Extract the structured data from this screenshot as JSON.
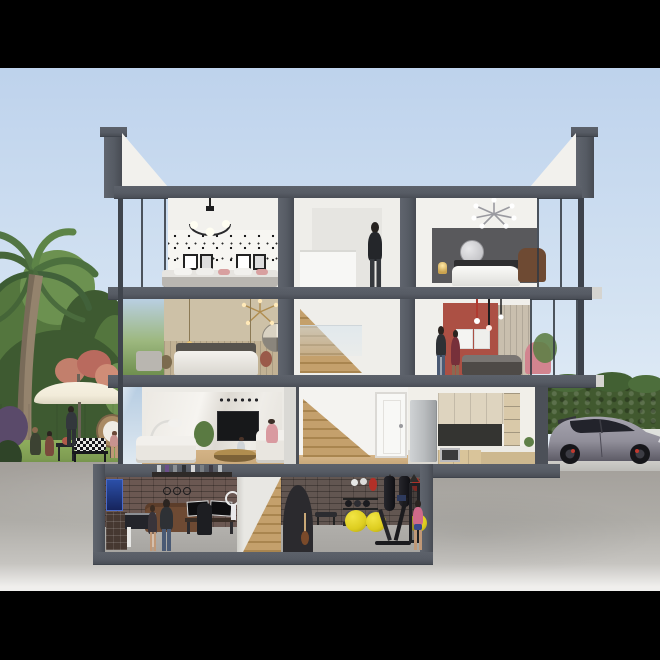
{
  "scene": {
    "description": "Photorealistic architectural cutaway rendering of a four-storey modern townhouse, letterboxed with black bars; interiors of every floor are exposed in section, with a palm-tree garden on the left and a silver hot-hatchback parked on a driveway to the right, all sitting in textured concrete ground below grade.",
    "style": "3D section / elevation render",
    "letterbox": "black bars across the top and bottom of the frame",
    "people_total": 12,
    "floors": [
      {
        "id": "top-floor",
        "label": "Top floor",
        "rooms": [
          {
            "id": "wallpaper-bedroom",
            "objects": [
              "black-and-white motif wallpaper",
              "four framed prints",
              "bed with pink accent pillows",
              "black ring chandelier with three globe bulbs",
              "floor-to-ceiling glazing"
            ]
          },
          {
            "id": "stair-landing",
            "objects": [
              "white landing walls",
              "half-height balustrade",
              "man standing with his back turned"
            ]
          },
          {
            "id": "grey-bedroom",
            "objects": [
              "dark grey feature wall",
              "round silver wall mirror",
              "white duvet bed with dark pillows",
              "tan leather armchair",
              "silver sputnik ceiling light",
              "lit bedside lamp"
            ]
          }
        ]
      },
      {
        "id": "second-floor",
        "label": "Second floor",
        "rooms": [
          {
            "id": "beige-bedroom",
            "objects": [
              "beige feature wall with timber slat panelling",
              "two-tone circular wall art",
              "gold sputnik chandelier",
              "two hanging filament bulbs",
              "upholstered bed with white duvet",
              "grey window bench",
              "flower vases"
            ]
          },
          {
            "id": "stairwell",
            "objects": [
              "timber stair flight",
              "glass balustrade"
            ]
          },
          {
            "id": "red-bedroom",
            "objects": [
              "terracotta-red feature wall",
              "two framed artworks",
              "black-and-red pendant rods",
              "dark-dressed bed",
              "pink occasional chair",
              "potted plant",
              "standing couple"
            ]
          }
        ]
      },
      {
        "id": "ground-floor",
        "label": "Ground floor",
        "rooms": [
          {
            "id": "living-room",
            "objects": [
              "book-matched marble media wall",
              "wall-mounted television",
              "two facing white sofas",
              "round brass coffee table",
              "white arc floor lamp",
              "potted plant",
              "seated woman",
              "toddler playing"
            ]
          },
          {
            "id": "entrance-hall",
            "objects": [
              "timber staircase",
              "white internal door"
            ]
          },
          {
            "id": "kitchen",
            "objects": [
              "stainless fridge-freezer",
              "cream upper cabinets",
              "dark stone splashback",
              "built-in oven",
              "L-shaped worktop",
              "open shelving with jars"
            ]
          }
        ]
      },
      {
        "id": "basement",
        "label": "Basement",
        "rooms": [
          {
            "id": "games-room",
            "objects": [
              "exposed brick wall",
              "glowing blue posters",
              "figurine display shelf",
              "multi-drawer chest",
              "foosball table",
              "brown leather sofa",
              "dual-monitor gaming desk",
              "gaming chair",
              "ring light",
              "father and daughter playing foosball"
            ]
          },
          {
            "id": "basement-stairs",
            "objects": [
              "timber staircase",
              "dark under-stair arch"
            ]
          },
          {
            "id": "home-gym",
            "objects": [
              "brick wall",
              "two hanging punch bags",
              "red speed bags",
              "white wall pads",
              "dumbbell and kettlebell rack",
              "three yellow exercise balls",
              "black cardio machines",
              "workout bench",
              "woman jogging"
            ]
          }
        ]
      }
    ],
    "exterior": {
      "left_garden": [
        "curved palm tree",
        "dense green trees and shrubs",
        "pink flowering bush",
        "white boundary fence",
        "cream parasol",
        "rattan hanging egg chair",
        "black bench with chequered cushions",
        "bistro table",
        "seated couple",
        "standing man",
        "small child",
        "lawn"
      ],
      "right_drive": [
        "clipped hedge",
        "silver-grey hatchback with red brake calipers",
        "light concrete driveway"
      ],
      "below_grade": "textured concrete ground wrapping the basement box"
    }
  },
  "colors": {
    "sky-top": "#bdd2ec",
    "sky-mid": "#d3e2f2",
    "sky-low": "#e9f1f8",
    "slab": "#565b64",
    "slab-dark": "#3f444c",
    "wall": "#f2f1ed",
    "hall": "#efeeea",
    "glass-top": "#b7cde2",
    "glass-low": "#dfe9f1",
    "wood-floor": "#c9a97b",
    "stair-wood": "#c4a06c",
    "stair-wood-dark": "#a9854f",
    "concrete": "#aeaca7",
    "concrete-light": "#f0efed",
    "grass": "#7e9c52",
    "grass-dark": "#5f7d3c",
    "tree-dark": "#3e5a31",
    "tree-mid": "#54763e",
    "tree-light": "#6c9150",
    "palm-trunk": "#94836d",
    "fence": "#eaeef0",
    "umbrella": "#f2ecda",
    "brick": "#6b5852",
    "brick-gym": "#625651",
    "basement-floor": "#a7a5a1",
    "marble": "#eae7e1",
    "tv": "#17181a",
    "beige-wall": "#cdc1a7",
    "red-wall": "#ac5044",
    "grey-wall": "#59595c",
    "cab-upper": "#ded4bf",
    "cab-lower": "#d9c49a",
    "splashback": "#343431",
    "fridge": "#b9bcbe",
    "sofa": "#e9e6e0",
    "brass": "#b08d4f",
    "ball-yellow": "#ddcd1f",
    "car-body": "#918f9a",
    "car-dark": "#3f3f47",
    "caliper-red": "#c03a30",
    "skin": "#c09877",
    "denim": "#4a5a74",
    "dark-cloth": "#2b2e33",
    "red-dress": "#77303a",
    "pink": "#d2848f",
    "leather": "#6e4a33"
  }
}
